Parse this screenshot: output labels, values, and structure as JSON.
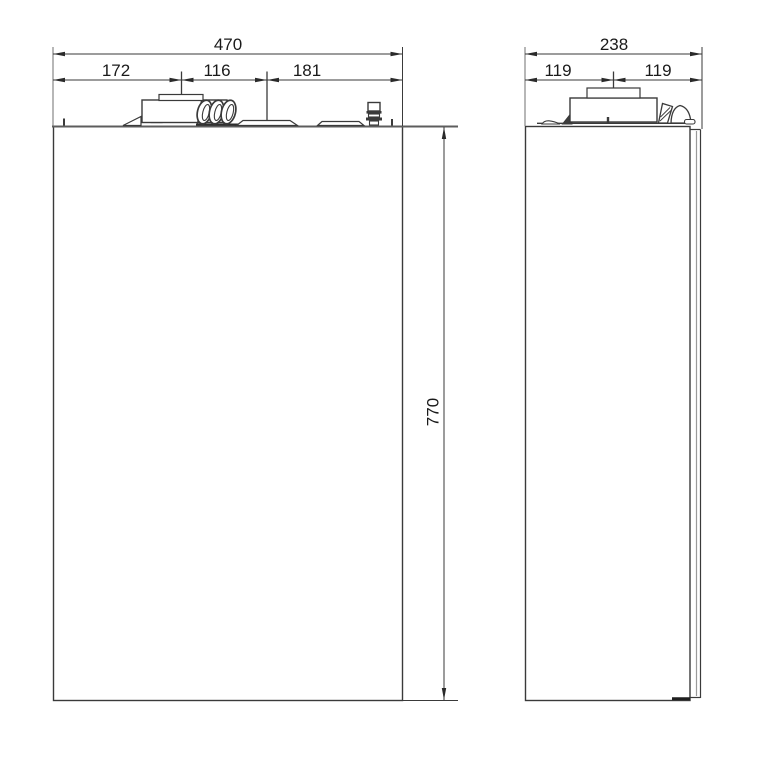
{
  "drawing": {
    "title": "wall-hung-appliance-dimension-drawing",
    "front_view": {
      "width_total": "470",
      "width_seg_left": "172",
      "width_seg_mid": "116",
      "width_seg_right": "181",
      "height_total": "770"
    },
    "side_view": {
      "depth_total": "238",
      "depth_seg_left": "119",
      "depth_seg_right": "119"
    },
    "colors": {
      "line": "#3a3a3a",
      "extension_line": "#6f6f6f",
      "text": "#1a1a1a",
      "background": "#ffffff"
    }
  }
}
